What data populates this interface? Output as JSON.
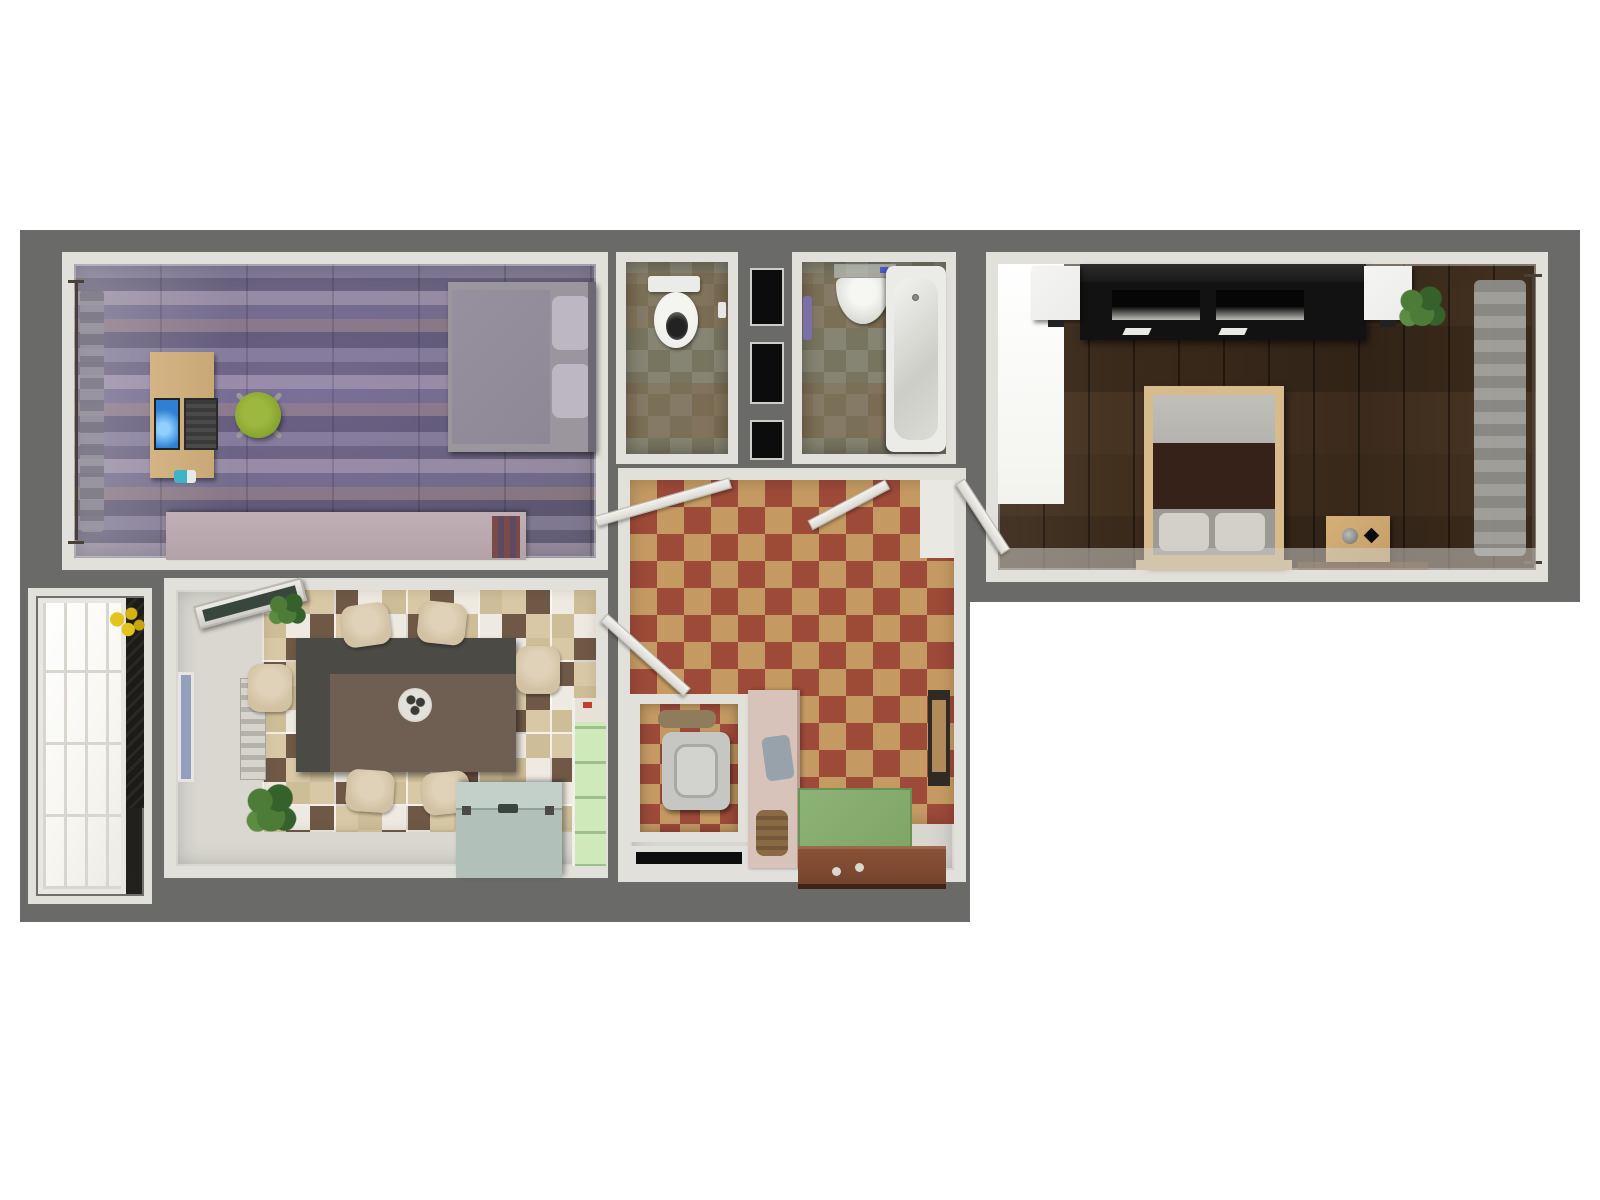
{
  "scene": {
    "label": "Top-down 3D render of a one-bedroom apartment floor plan",
    "background": "#ffffff"
  },
  "colors": {
    "pageBg": "#ffffff",
    "slab": "#6a6a68",
    "wall": "#e2e0da",
    "officeStoneA": "#8f88a1",
    "officeStoneB": "#6f6982",
    "officeStoneC": "#a79db0",
    "officeStoneD": "#7b7592",
    "officeStoneE": "#96858b",
    "officeStoneF": "#655f79",
    "officeDesk": "#c9a876",
    "laptopScreen": "#2f7fd4",
    "laptopBody": "#3a3a3a",
    "phoneTeal": "#3fb3c7",
    "chairGreen": "#84a12e",
    "chairBase": "#9a9a96",
    "officeBedBlanket": "#8e8795",
    "officeBedMattress": "#9b959e",
    "officeBedPillow": "#bcb7c2",
    "headboard": "#6e6875",
    "sideboard": "#b3a2a7",
    "tileA": "#77755f",
    "tileB": "#868472",
    "porcelain": "#ebebe7",
    "towelPurple": "#7b6fa8",
    "shaftBlack": "#0c0c0c",
    "diamondRed": "#9d4a39",
    "diamondTan": "#c59a62",
    "plainHallFloor": "#d8d6cf",
    "woodDark": "#3e2d1d",
    "unitBlack": "#121212",
    "speakerWhite": "#ececea",
    "bedFrame": "#d7bb8d",
    "bedMid": "#362219",
    "bedMattress": "#b4b3ae",
    "bedPillow": "#d3d0ca",
    "curtainGray": "#999994",
    "nightstand": "#c49e66",
    "brightPanel": "#f3f3ee",
    "checkerBrown": "#6f5946",
    "checkerWhite": "#efeae1",
    "checkerTan": "#d6c6a0",
    "tableDark": "#4b4a45",
    "tableBrown": "#6e5f52",
    "chairBeige": "#d2c1a3",
    "freezer": "#b2c0ba",
    "freezerLid": "#c3d0ca",
    "cabinetGreen": "#cfe9bb",
    "glassBlue": "#93a0bd",
    "radiator": "#cfcdc6",
    "balconyPane": "#f7f6f1",
    "balconyDark": "#1d1b18",
    "flowerYellow": "#e3c31e",
    "matGreen": "#7fa667",
    "entryDoor": "#73422c",
    "partitionPink": "#d8c3ba",
    "machineGray": "#c6c6c2",
    "basketBrown": "#8a6a44",
    "towelGray": "#98a2ab",
    "plantGreen": "#4c7c38",
    "plantGreenDark": "#35622a",
    "doorWhite": "#efeee9"
  },
  "rooms": {
    "office": {
      "label": "Study bedroom: slate floor, desk with laptop and phone, green swivel chair, gray single bed, mauve sideboard, curtained left window"
    },
    "wc": {
      "label": "WC: olive tiled floor, toilet with tank at top wall"
    },
    "shaft": {
      "label": "Utility shaft with three dark openings"
    },
    "bathroom": {
      "label": "Bathroom: olive tiled floor, glass shelf, half-round sink, bathtub on right wall, purple towel"
    },
    "bedroom": {
      "label": "Bedroom: dark wood plank floor, black media unit with two white speakers, double bed with light wood frame, nightstand, plant, gray curtain on right window"
    },
    "dining": {
      "label": "Kitchen-dining room: brown/tan checkered tiles, dark dining table with bowl and six beige chairs, tilted-open window with plant, radiator, chest freezer, green cabinet, floor plants"
    },
    "hallway": {
      "label": "Entry hall: red and tan diamond tiles, four open white doors, washing machine closet, pink partition with towel and basket, green doormat, open brown entry door, leaning picture frame"
    },
    "balcony": {
      "label": "Balcony: large white paned window, dark side wall, yellow flowers"
    }
  }
}
